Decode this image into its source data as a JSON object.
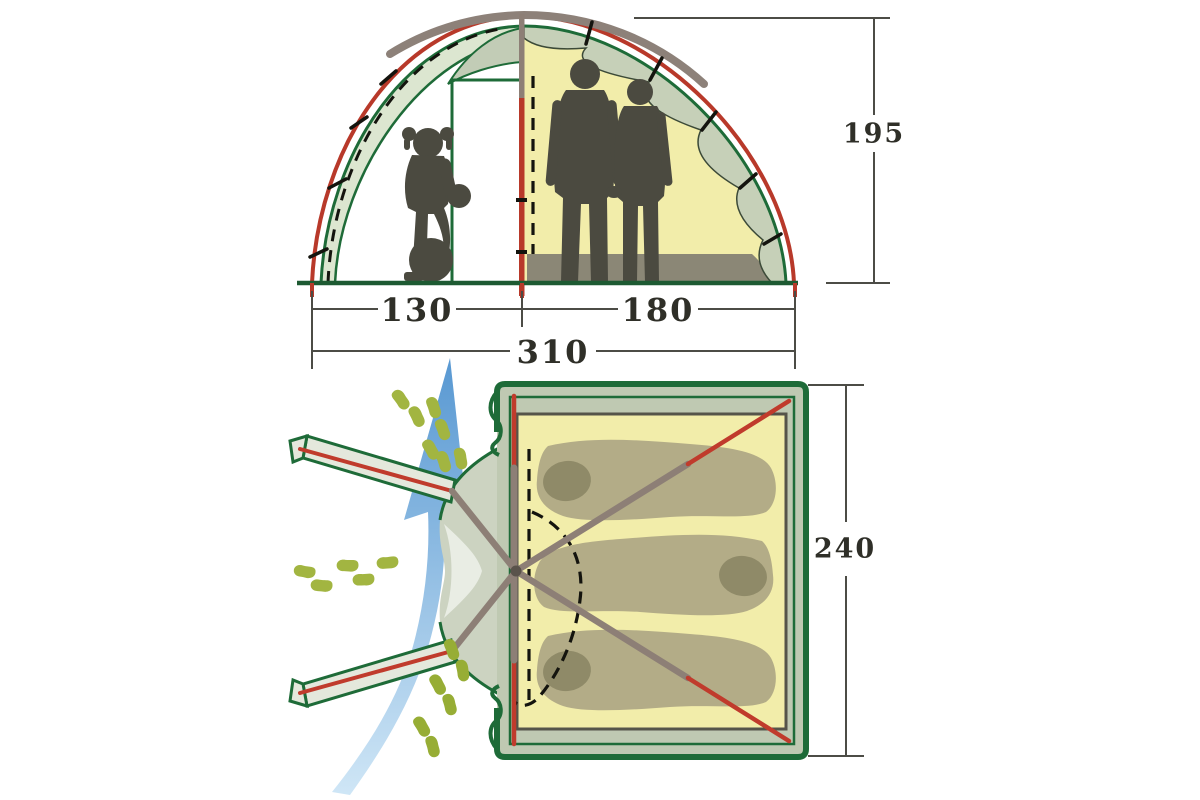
{
  "diagram_title": "Tent dimensions diagram",
  "views": {
    "cross_section": {
      "name": "front cross-section",
      "labels": {
        "height": "195",
        "vestibule_width": "130",
        "inner_width": "180",
        "total_width": "310"
      }
    },
    "floor_plan": {
      "name": "top floor plan",
      "labels": {
        "depth": "240"
      }
    }
  },
  "icons": {
    "airflow-arrow-icon": "curved blue arrow showing airflow through entrance",
    "footprints-icon": "green footprint trails marking walk-in paths",
    "child-silhouette": "child standing on a ball in the vestibule",
    "adults-silhouette": "two adults standing in the inner tent",
    "sleeping-bags-icon": "three sleeping bags laid head-to-toe",
    "tent-pole-icon": "crossed frame poles, red with gray sleeves"
  },
  "colors": {
    "bg": "#ffffff",
    "outerRed": "#b8392a",
    "flyGray": "#8d8179",
    "frameGreen": "#1e6b38",
    "groundGreen": "#1d5a32",
    "bandPale": "#dce6d0",
    "scallopFill": "#c6d0b8",
    "scallopEdge": "#3c4a38",
    "innerYellow": "#f2edaa",
    "matGray": "#8b8776",
    "silhouette": "#4b4a40",
    "marginGreen": "#bfc9b2",
    "funnelGray": "#ccd3c1",
    "funnelLight": "#e9ede4",
    "armFill": "#e4e8dc",
    "poleGray": "#8d7f76",
    "poleRed": "#c03b2c",
    "wedgeFill": "#c2ccb6",
    "innerEdgeDark": "#55544a",
    "bagFill": "#b3ac87",
    "bagHood": "#8f8a68",
    "footGreen": "#a2b541",
    "footGreenDark": "#97ad35",
    "arrowTop": "#5898d2",
    "arrowBottom": "#cfe6f6",
    "dimLine": "#4c4c46",
    "dimText": "#2f2f28",
    "dash": "#14140e"
  }
}
